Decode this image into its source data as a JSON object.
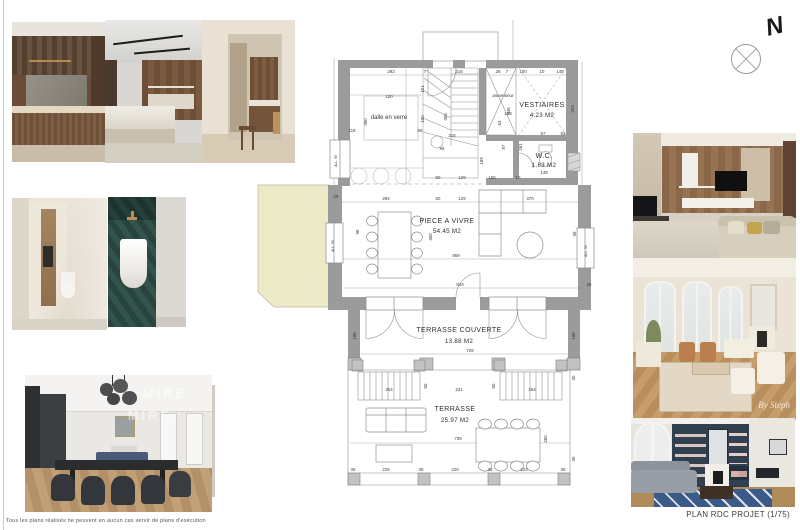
{
  "page": {
    "disclaimer": "Tous les plans réalisés ne peuvent en aucun cas servir de plans d'exécution",
    "plan_title": "PLAN RDC PROJET (1/75)",
    "north_label": "N"
  },
  "watermarks": {
    "dining": [
      "MIRE",
      "MIRE"
    ],
    "signature": "By Steph"
  },
  "colors": {
    "wall": "#9b9b9b",
    "terrace_fill": "#edeac7",
    "dim_text": "#3a3a3a",
    "line": "#8f8f8f"
  },
  "plan": {
    "rooms": [
      {
        "name": "VESTIAIRES",
        "area": "4.23 M2",
        "x": 296,
        "y": 89,
        "ax": 296,
        "ay": 99
      },
      {
        "name": "W.C.",
        "area": "1.63 M2",
        "x": 298,
        "y": 140,
        "ax": 298,
        "ay": 149
      },
      {
        "name": "PIECE A VIVRE",
        "area": "54.45 M2",
        "x": 201,
        "y": 205,
        "ax": 201,
        "ay": 215
      },
      {
        "name": "TERRASSE COUVERTE",
        "area": "13.88 M2",
        "x": 213,
        "y": 314,
        "ax": 213,
        "ay": 325
      },
      {
        "name": "TERRASSE",
        "area": "25.97 M2",
        "x": 209,
        "y": 393,
        "ax": 209,
        "ay": 404
      }
    ],
    "annotations": [
      {
        "t": "dalle en verre",
        "x": 143,
        "y": 101,
        "s": 6
      },
      {
        "t": "ascenseur",
        "x": 257,
        "y": 79,
        "s": 4.6
      },
      {
        "t": "ALL. 95",
        "x": 88,
        "y": 228,
        "r": 1,
        "s": 3.4
      },
      {
        "t": "ALL. 95",
        "x": 341,
        "y": 233,
        "r": 1,
        "s": 3.4
      },
      {
        "t": "ALL. 95",
        "x": 91,
        "y": 143,
        "r": 1,
        "s": 3.4
      }
    ],
    "dimensions": [
      {
        "t": "292",
        "x": 145,
        "y": 55
      },
      {
        "t": "7",
        "x": 179,
        "y": 55
      },
      {
        "t": "218",
        "x": 213,
        "y": 55
      },
      {
        "t": "28",
        "x": 252,
        "y": 55
      },
      {
        "t": "7",
        "x": 261,
        "y": 55
      },
      {
        "t": "100",
        "x": 277,
        "y": 55
      },
      {
        "t": "10",
        "x": 296,
        "y": 55
      },
      {
        "t": "149",
        "x": 314,
        "y": 55
      },
      {
        "t": "120",
        "x": 143,
        "y": 80
      },
      {
        "t": "101",
        "x": 178,
        "y": 71,
        "r": 1
      },
      {
        "t": "345",
        "x": 264,
        "y": 93,
        "r": 1
      },
      {
        "t": "204",
        "x": 328,
        "y": 91,
        "r": 1
      },
      {
        "t": "118",
        "x": 106,
        "y": 114
      },
      {
        "t": "56",
        "x": 174,
        "y": 114
      },
      {
        "t": "360",
        "x": 121,
        "y": 104,
        "r": 1
      },
      {
        "t": "130",
        "x": 178,
        "y": 101,
        "r": 1
      },
      {
        "t": "305",
        "x": 201,
        "y": 99,
        "r": 1
      },
      {
        "t": "215",
        "x": 206,
        "y": 119
      },
      {
        "t": "96",
        "x": 196,
        "y": 132
      },
      {
        "t": "138",
        "x": 262,
        "y": 97
      },
      {
        "t": "63",
        "x": 255,
        "y": 105,
        "r": 1
      },
      {
        "t": "87",
        "x": 259,
        "y": 129,
        "r": 1
      },
      {
        "t": "261",
        "x": 276,
        "y": 129,
        "r": 1
      },
      {
        "t": "189",
        "x": 237,
        "y": 143,
        "r": 1
      },
      {
        "t": "67",
        "x": 297,
        "y": 117
      },
      {
        "t": "92",
        "x": 317,
        "y": 117
      },
      {
        "t": "50",
        "x": 192,
        "y": 161
      },
      {
        "t": "129",
        "x": 216,
        "y": 161
      },
      {
        "t": "165",
        "x": 246,
        "y": 161
      },
      {
        "t": "10",
        "x": 272,
        "y": 161
      },
      {
        "t": "149",
        "x": 298,
        "y": 156
      },
      {
        "t": "25",
        "x": 90,
        "y": 180
      },
      {
        "t": "294",
        "x": 140,
        "y": 182
      },
      {
        "t": "50",
        "x": 192,
        "y": 182
      },
      {
        "t": "129",
        "x": 216,
        "y": 182
      },
      {
        "t": "370",
        "x": 284,
        "y": 182
      },
      {
        "t": "98",
        "x": 113,
        "y": 214,
        "r": 1
      },
      {
        "t": "400",
        "x": 186,
        "y": 219,
        "r": 1
      },
      {
        "t": "95",
        "x": 330,
        "y": 216,
        "r": 1
      },
      {
        "t": "869",
        "x": 210,
        "y": 239
      },
      {
        "t": "843",
        "x": 214,
        "y": 268
      },
      {
        "t": "26",
        "x": 343,
        "y": 268
      },
      {
        "t": "188",
        "x": 110,
        "y": 318,
        "r": 1
      },
      {
        "t": "188",
        "x": 329,
        "y": 318,
        "r": 1
      },
      {
        "t": "728",
        "x": 224,
        "y": 334
      },
      {
        "t": "254",
        "x": 143,
        "y": 373
      },
      {
        "t": "50",
        "x": 181,
        "y": 368,
        "r": 1
      },
      {
        "t": "231",
        "x": 213,
        "y": 373
      },
      {
        "t": "50",
        "x": 249,
        "y": 368,
        "r": 1
      },
      {
        "t": "254",
        "x": 286,
        "y": 373
      },
      {
        "t": "739",
        "x": 212,
        "y": 422
      },
      {
        "t": "260",
        "x": 301,
        "y": 421,
        "r": 1
      },
      {
        "t": "30",
        "x": 329,
        "y": 360,
        "r": 1
      },
      {
        "t": "30",
        "x": 329,
        "y": 441,
        "r": 1
      },
      {
        "t": "35",
        "x": 107,
        "y": 453
      },
      {
        "t": "225",
        "x": 140,
        "y": 453
      },
      {
        "t": "35",
        "x": 175,
        "y": 453
      },
      {
        "t": "220",
        "x": 209,
        "y": 453
      },
      {
        "t": "35",
        "x": 244,
        "y": 453
      },
      {
        "t": "224",
        "x": 278,
        "y": 453
      },
      {
        "t": "35",
        "x": 317,
        "y": 453
      }
    ]
  }
}
